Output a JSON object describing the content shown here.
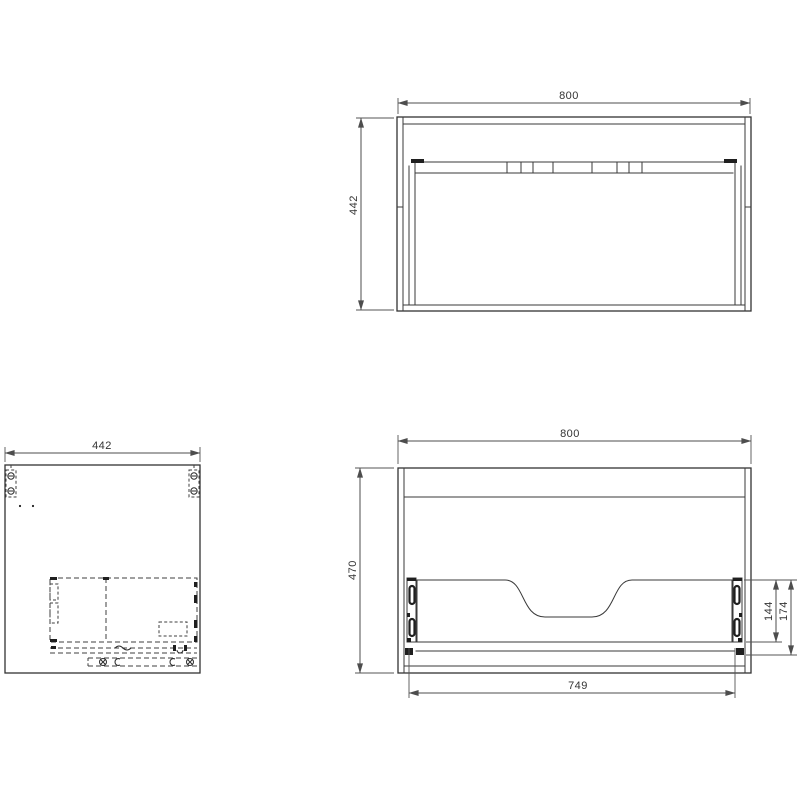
{
  "page": {
    "background": "#ffffff",
    "line_color": "#333333",
    "dimension_color": "#4d4d4d",
    "drawing_type": "cabinet technical drawing, three orthographic views"
  },
  "views": {
    "top": {
      "name": "top-plan-view",
      "dims": {
        "width": "800",
        "depth": "442"
      }
    },
    "side": {
      "name": "side-panel-view",
      "dims": {
        "width": "442"
      },
      "symbols": [
        "cam-lock-hole-icon",
        "dowel-dot-icon",
        "hidden-drawer-slide-outline",
        "screw-cross-icon",
        "clip-icon"
      ]
    },
    "front": {
      "name": "front-open-view",
      "dims": {
        "width": "800",
        "height": "470",
        "inner_width": "749",
        "slide_height": "144",
        "back_offset": "174"
      },
      "symbols": [
        "drawer-slide-rail-icon",
        "siphon-cutout-notch"
      ]
    }
  }
}
